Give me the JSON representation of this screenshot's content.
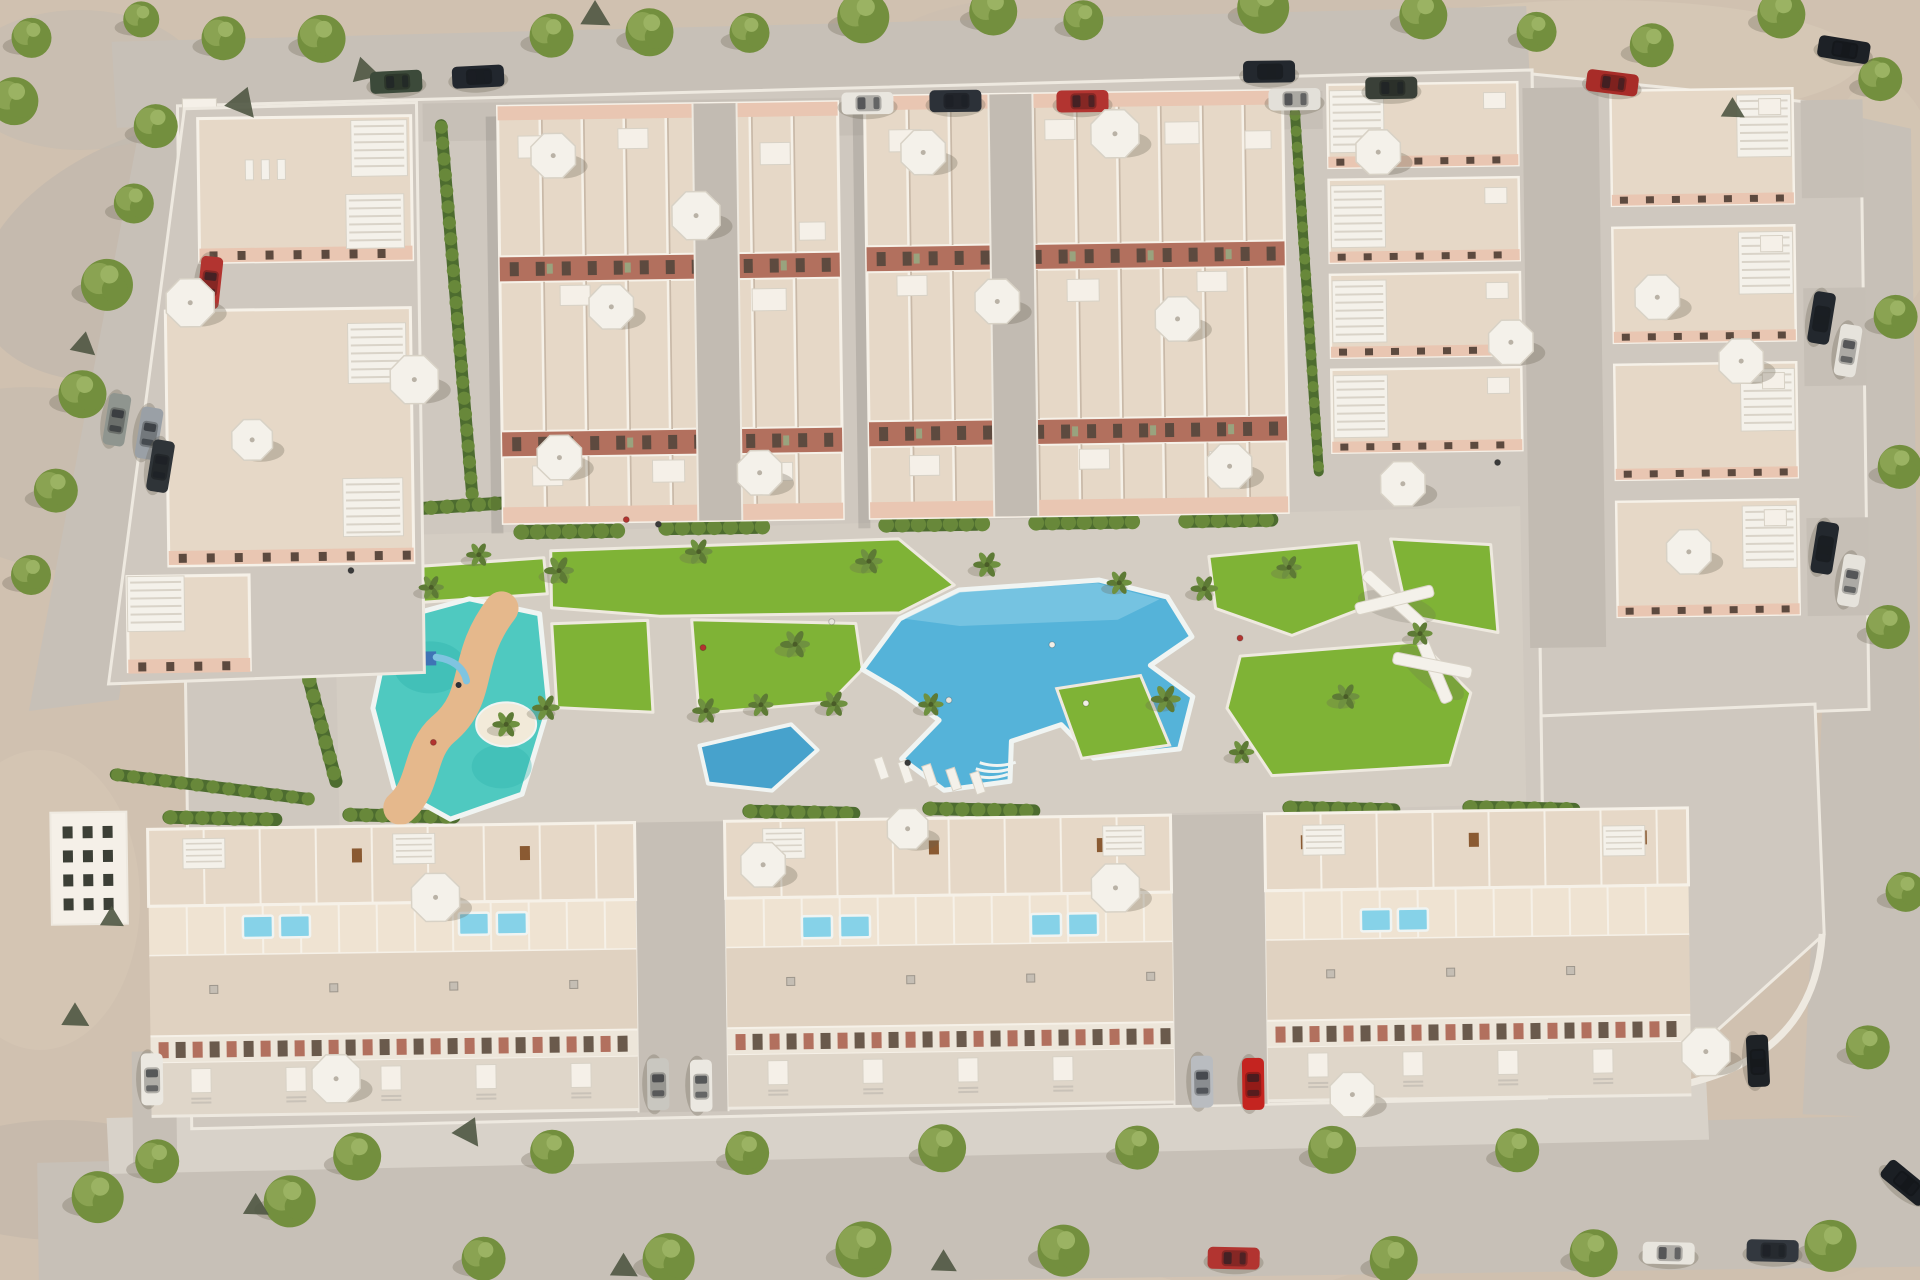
{
  "meta": {
    "title": "Aerial 3D render of a residential complex with pools and gardens"
  },
  "scene": {
    "width": 1920,
    "height": 1280,
    "tilt": -0.8
  },
  "palette": {
    "sand": "#d0c1b0",
    "road": "#c7c0b7",
    "sidewalk": "#d8d2c9",
    "paving": "#cfc8bf",
    "esplanade": "#d5cec4",
    "aisle": "#c6bfb6",
    "walkway": "#c2bbb2",
    "terrace": "#e6d8c7",
    "terraceLight": "#efe3d2",
    "roof": "#e0d2c1",
    "parapet": "#f6f1e8",
    "boxFill": "#f5f0e8",
    "wallShadow": "#c9b9a8",
    "facadePink": "#e9c6b2",
    "facadeTerracotta": "#b2705e",
    "windowDark": "#5d4a3f",
    "windowPair": "#6a5a4c",
    "shutterGreen": "#99a37e",
    "lawn": "#7fb336",
    "lawnEdge": "#eee9df",
    "hedge": "#4d6c2f",
    "bushA": "#68883a",
    "bushB": "#577a30",
    "pool": "#55b3d9",
    "poolLight": "#8fd0e8",
    "poolRim": "#f0f4f2",
    "lagoon": "#47a2cc",
    "kidsPool": "#4fc9c0",
    "kidsPoolDark": "#2fb3ac",
    "sandPath": "#e5b88c",
    "miniPool": "#86d2e8",
    "treeShadow": "#6b6453",
    "treeA": "#8aa352",
    "treeB": "#738f3e",
    "treeC": "#9bb363",
    "palmA": "#5d7a35",
    "palmB": "#6f9140",
    "white": "#f4f1ea",
    "umbrellaEdge": "#d8d2c6",
    "furniture": "#8a5a32",
    "rock": "#4f5742",
    "slatLine": "#d9d3c8",
    "curb": "#eee9e0"
  },
  "terrain_patches": [
    [
      170,
      250,
      200,
      120,
      -20,
      "#b9b3ac",
      0.5
    ],
    [
      60,
      480,
      160,
      90,
      10,
      "#bdb7b0",
      0.4
    ],
    [
      300,
      1215,
      240,
      70,
      0,
      "#c0b4a6",
      0.35
    ],
    [
      900,
      1235,
      500,
      90,
      0,
      "#dccdbb",
      0.5
    ],
    [
      1600,
      60,
      260,
      60,
      0,
      "#ddd0bd",
      0.4
    ],
    [
      1200,
      35,
      300,
      50,
      0,
      "#c8bcae",
      0.3
    ],
    [
      500,
      1255,
      300,
      60,
      0,
      "#c6b8a8",
      0.4
    ],
    [
      1500,
      1240,
      400,
      70,
      0,
      "#cdbfb0",
      0.4
    ],
    [
      80,
      80,
      120,
      70,
      0,
      "#c2bbb2",
      0.5
    ],
    [
      40,
      900,
      100,
      150,
      0,
      "#d9cab8",
      0.4
    ],
    [
      1880,
      200,
      60,
      120,
      0,
      "#d8cab8",
      0.4
    ],
    [
      700,
      60,
      200,
      40,
      0,
      "#cfc2b2",
      0.35
    ],
    [
      60,
      1180,
      140,
      60,
      0,
      "#b4aca2",
      0.3
    ],
    [
      1750,
      1180,
      160,
      60,
      0,
      "#c4b6a6",
      0.35
    ]
  ],
  "roads": {
    "top": "120,30 1535,14 1538,100 124,116",
    "left": "150,100 222,96 118,688 28,698",
    "bottom": "30,1150 1920,1128 1920,1280 30,1280",
    "bottom_sidewalk": "100,1106 1700,1092 1702,1150 102,1162",
    "right": "1858,128 1918,142 1918,1132 1796,1126"
  },
  "complex": {
    "plates": [
      "185,95 1540,78 1540,1106 185,1118",
      "1540,82 1868,120 1868,722 1540,730",
      "1540,724 1814,716 1820,946 1642,1102 1540,1104"
    ],
    "north_sidewalk": [
      430,
      96,
      900,
      38
    ],
    "esplanade": "335,528 1522,514 1524,812 337,826",
    "se_curve": "M 1642,1100 Q 1808,1082 1818,946",
    "gate_box": [
      190,
      88,
      34,
      20
    ],
    "sw_building": [
      48,
      800,
      76,
      112
    ],
    "row1_west_drive": [
      126,
      1040,
      44,
      112
    ]
  },
  "top_blocks": [
    {
      "x": 505,
      "y": 100,
      "w": 340,
      "h": 417,
      "walk": 700,
      "boxes": [
        [
          20,
          30,
          34,
          22
        ],
        [
          120,
          24,
          30,
          20
        ],
        [
          262,
          40,
          30,
          22
        ],
        [
          60,
          180,
          30,
          20
        ],
        [
          252,
          186,
          34,
          22
        ],
        [
          300,
          120,
          26,
          18
        ],
        [
          30,
          360,
          30,
          20
        ],
        [
          150,
          356,
          32,
          22
        ],
        [
          262,
          360,
          28,
          18
        ]
      ]
    },
    {
      "x": 872,
      "y": 95,
      "w": 418,
      "h": 422,
      "walk": 996,
      "boxes": [
        [
          24,
          34,
          32,
          22
        ],
        [
          180,
          26,
          30,
          20
        ],
        [
          300,
          30,
          34,
          22
        ],
        [
          380,
          40,
          26,
          18
        ],
        [
          30,
          180,
          30,
          20
        ],
        [
          200,
          186,
          32,
          22
        ],
        [
          330,
          180,
          30,
          20
        ],
        [
          40,
          360,
          30,
          20
        ],
        [
          210,
          356,
          30,
          20
        ],
        [
          340,
          360,
          32,
          22
        ]
      ]
    }
  ],
  "left_apartments": {
    "base": "192,98 424,95 424,665 108,672",
    "buildings": [
      {
        "x": 205,
        "y": 108,
        "w": 213,
        "h": 144,
        "facY": 238,
        "slats": [
          [
            358,
            112,
            56,
            56
          ],
          [
            352,
            186,
            58,
            54
          ]
        ]
      },
      {
        "x": 170,
        "y": 300,
        "w": 245,
        "h": 255,
        "facY": 540,
        "slats": [
          [
            352,
            315,
            58,
            60
          ],
          [
            345,
            470,
            60,
            58
          ]
        ]
      },
      {
        "x": 128,
        "y": 565,
        "w": 122,
        "h": 95,
        "facY": 648,
        "slats": [
          [
            128,
            565,
            57,
            55
          ]
        ]
      }
    ],
    "loungers": [
      [
        252,
        150
      ],
      [
        268,
        150
      ],
      [
        284,
        150
      ]
    ]
  },
  "right_columns": {
    "c1": {
      "x": 1335,
      "w": 190,
      "ys": [
        90,
        185,
        280,
        375
      ],
      "h": 83,
      "slatSide": "w"
    },
    "c2": {
      "x": 1618,
      "w": 182,
      "ys": [
        100,
        237,
        374,
        511
      ],
      "h": 115,
      "slatSide": "e"
    },
    "lane": [
      1530,
      96,
      76,
      560
    ],
    "driveways": [
      [
        1808,
        112,
        62,
        98
      ],
      [
        1808,
        300,
        62,
        98
      ],
      [
        1808,
        530,
        62,
        98
      ]
    ]
  },
  "amenity": {
    "lawns": [
      "552,545 900,538 955,585 900,612 660,612 552,602",
      "552,618 648,616 652,708 556,702",
      "692,616 856,622 862,668 830,700 698,710",
      "398,560 545,552 548,588 402,596",
      "1210,560 1360,548 1368,612 1292,640 1216,612",
      "1392,545 1492,552 1498,640 1408,622",
      "1240,660 1420,648 1470,700 1448,772 1270,780 1226,712"
    ],
    "pool": {
      "body": "900,618 960,590 1100,582 1168,600 1192,640 1150,668 1192,700 1178,752 1092,760 1060,726 1010,742 1008,782 942,790 900,758 938,720 898,690 862,668",
      "light": "905,618 960,592 1098,585 1160,602 1118,622 960,626",
      "island": "1056,690 1140,678 1168,748 1080,760",
      "steps": [
        988,
        775
      ]
    },
    "lagoon": "698,742 790,722 816,748 770,788 706,780",
    "kids_pool": {
      "body": "392,612 470,592 540,608 548,700 520,788 448,812 392,780 372,700",
      "path": "M 502,602 C 462,652 482,690 442,722 C 416,744 424,778 398,800",
      "island": [
        505,
        718,
        30,
        22
      ],
      "playground": [
        424,
        644
      ]
    },
    "pergolas": [
      [
        1395,
        606,
        15
      ],
      [
        1432,
        672,
        40
      ]
    ],
    "loungers": [
      [
        872,
        758
      ],
      [
        896,
        762
      ],
      [
        920,
        766
      ],
      [
        944,
        770
      ],
      [
        968,
        774
      ]
    ],
    "people": [
      [
        660,
        520,
        "#3a3a3a"
      ],
      [
        703,
        644,
        "#b23430"
      ],
      [
        832,
        620,
        "#e8e5de"
      ],
      [
        906,
        762,
        "#3a3a3a"
      ],
      [
        1240,
        642,
        "#b23430"
      ],
      [
        352,
        562,
        "#3a3a3a"
      ],
      [
        432,
        735,
        "#b23430"
      ],
      [
        948,
        700,
        "#e8e5de"
      ],
      [
        1052,
        646,
        "#f2efe8"
      ],
      [
        1085,
        705,
        "#f2efe8"
      ],
      [
        628,
        515,
        "#b23430"
      ],
      [
        1500,
        470,
        "#3a3a3a"
      ]
    ]
  },
  "bottom_rows": {
    "rows": [
      {
        "x": 145,
        "w": 487
      },
      {
        "x": 722,
        "w": 446
      },
      {
        "x": 1262,
        "w": 423
      }
    ],
    "bands": {
      "back": [
        818,
        895
      ],
      "pools": [
        895,
        945
      ],
      "roof": [
        945,
        1025
      ],
      "windows": [
        1025,
        1052
      ],
      "front": [
        1052,
        1105
      ]
    },
    "aisles": [
      [
        632,
        818,
        90,
        290
      ],
      [
        1168,
        818,
        94,
        290
      ]
    ],
    "slat_boxes": [
      [
        180,
        828
      ],
      [
        390,
        826
      ],
      [
        760,
        826
      ],
      [
        1100,
        828
      ],
      [
        1300,
        830
      ],
      [
        1600,
        835
      ]
    ],
    "mini_pools": [
      [
        254,
        917
      ],
      [
        291,
        917
      ],
      [
        470,
        917
      ],
      [
        508,
        917
      ],
      [
        813,
        925
      ],
      [
        851,
        925
      ],
      [
        1042,
        926
      ],
      [
        1079,
        926
      ],
      [
        1372,
        926
      ],
      [
        1409,
        926
      ]
    ]
  },
  "hedges": [
    [
      515,
      526,
      105,
      14,
      0
    ],
    [
      660,
      524,
      105,
      14,
      0
    ],
    [
      880,
      524,
      105,
      14,
      0
    ],
    [
      1030,
      524,
      105,
      14,
      0
    ],
    [
      1180,
      524,
      100,
      14,
      0
    ],
    [
      448,
      112,
      380,
      12,
      86
    ],
    [
      1584,
      108,
      530,
      12,
      90
    ],
    [
      1302,
      112,
      370,
      10,
      87
    ],
    [
      160,
      806,
      120,
      13,
      2
    ],
    [
      340,
      806,
      118,
      13,
      2
    ],
    [
      740,
      808,
      118,
      13,
      2
    ],
    [
      920,
      808,
      118,
      13,
      2
    ],
    [
      1280,
      812,
      118,
      13,
      2
    ],
    [
      1460,
      814,
      118,
      13,
      2
    ],
    [
      108,
      762,
      205,
      12,
      8
    ],
    [
      303,
      648,
      135,
      13,
      76
    ],
    [
      345,
      505,
      195,
      13,
      -3
    ]
  ],
  "trees": [
    [
      232,
      28,
      22
    ],
    [
      330,
      30,
      24
    ],
    [
      560,
      30,
      22
    ],
    [
      658,
      28,
      24
    ],
    [
      758,
      30,
      20
    ],
    [
      872,
      16,
      26
    ],
    [
      1002,
      12,
      24
    ],
    [
      1092,
      22,
      20
    ],
    [
      1272,
      12,
      26
    ],
    [
      1432,
      22,
      24
    ],
    [
      1545,
      40,
      20
    ],
    [
      1660,
      55,
      22
    ],
    [
      1790,
      26,
      24
    ],
    [
      1888,
      92,
      22
    ],
    [
      40,
      25,
      20
    ],
    [
      150,
      8,
      18
    ],
    [
      22,
      88,
      24
    ],
    [
      163,
      115,
      22
    ],
    [
      140,
      192,
      20
    ],
    [
      112,
      273,
      26
    ],
    [
      86,
      382,
      24
    ],
    [
      58,
      478,
      22
    ],
    [
      32,
      562,
      20
    ],
    [
      150,
      1150,
      22
    ],
    [
      350,
      1148,
      24
    ],
    [
      545,
      1146,
      22
    ],
    [
      740,
      1150,
      22
    ],
    [
      935,
      1148,
      24
    ],
    [
      1130,
      1150,
      22
    ],
    [
      1325,
      1155,
      24
    ],
    [
      1510,
      1158,
      22
    ],
    [
      90,
      1185,
      26
    ],
    [
      282,
      1192,
      26
    ],
    [
      660,
      1255,
      26
    ],
    [
      855,
      1248,
      28
    ],
    [
      1055,
      1252,
      26
    ],
    [
      475,
      1252,
      22
    ],
    [
      1385,
      1266,
      24
    ],
    [
      1585,
      1262,
      24
    ],
    [
      1822,
      1258,
      26
    ],
    [
      1900,
      330,
      22
    ],
    [
      1902,
      480,
      22
    ],
    [
      1888,
      640,
      22
    ],
    [
      1902,
      905,
      20
    ],
    [
      1862,
      1060,
      22
    ]
  ],
  "palms": [
    [
      560,
      565,
      13
    ],
    [
      700,
      548,
      12
    ],
    [
      795,
      642,
      13
    ],
    [
      833,
      702,
      12
    ],
    [
      988,
      565,
      12
    ],
    [
      545,
      702,
      12
    ],
    [
      432,
      580,
      11
    ],
    [
      705,
      707,
      12
    ],
    [
      870,
      560,
      12
    ],
    [
      930,
      704,
      11
    ],
    [
      760,
      702,
      11
    ],
    [
      480,
      548,
      11
    ],
    [
      1205,
      592,
      12
    ],
    [
      1165,
      702,
      13
    ],
    [
      1290,
      572,
      11
    ],
    [
      1345,
      702,
      12
    ],
    [
      505,
      718,
      12
    ],
    [
      1120,
      585,
      11
    ],
    [
      1240,
      756,
      11
    ],
    [
      1420,
      640,
      11
    ]
  ],
  "rocks": [
    [
      250,
      92,
      16,
      20
    ],
    [
      372,
      62,
      14,
      -15
    ],
    [
      604,
      10,
      15,
      0
    ],
    [
      88,
      332,
      13,
      10
    ],
    [
      70,
      1004,
      14,
      0
    ],
    [
      462,
      1124,
      15,
      25
    ],
    [
      248,
      1196,
      13,
      0
    ],
    [
      615,
      1262,
      14,
      0
    ],
    [
      935,
      1262,
      13,
      0
    ],
    [
      108,
      906,
      12,
      0
    ],
    [
      1740,
      120,
      12,
      0
    ]
  ],
  "cars": [
    [
      404,
      74,
      -2,
      "#3c4a3a"
    ],
    [
      486,
      70,
      -2,
      "#22272e"
    ],
    [
      875,
      102,
      0,
      "#e9e6df"
    ],
    [
      963,
      101,
      0,
      "#2c3138"
    ],
    [
      1090,
      103,
      0,
      "#b23430"
    ],
    [
      1277,
      76,
      0,
      "#23282e"
    ],
    [
      1302,
      104,
      0,
      "#e3e0d9"
    ],
    [
      1399,
      94,
      0,
      "#3a4038"
    ],
    [
      1620,
      92,
      8,
      "#a82c28"
    ],
    [
      215,
      272,
      97,
      "#b23430"
    ],
    [
      152,
      422,
      100,
      "#9aa0a6"
    ],
    [
      163,
      455,
      100,
      "#2f3438"
    ],
    [
      120,
      408,
      100,
      "#8f958f"
    ],
    [
      1826,
      330,
      100,
      "#23282e"
    ],
    [
      1852,
      363,
      100,
      "#e6e3dc"
    ],
    [
      1826,
      560,
      100,
      "#23282e"
    ],
    [
      1852,
      593,
      100,
      "#e6e3dc"
    ],
    [
      1852,
      62,
      10,
      "#1d2126"
    ],
    [
      652,
      1080,
      90,
      "#c9c7c0"
    ],
    [
      695,
      1082,
      90,
      "#ebe8e1"
    ],
    [
      1196,
      1085,
      90,
      "#b9bcc0"
    ],
    [
      1247,
      1088,
      90,
      "#c42420"
    ],
    [
      146,
      1068,
      90,
      "#ebe8e1"
    ],
    [
      1752,
      1072,
      88,
      "#1e2226"
    ],
    [
      1225,
      1262,
      2,
      "#b23430"
    ],
    [
      1660,
      1263,
      2,
      "#e8e5de"
    ],
    [
      1764,
      1262,
      2,
      "#33383f"
    ],
    [
      1898,
      1196,
      40,
      "#1b1f24"
    ]
  ],
  "umbrellas": [
    [
      560,
      150,
      24
    ],
    [
      702,
      212,
      26
    ],
    [
      616,
      302,
      24
    ],
    [
      562,
      452,
      24
    ],
    [
      762,
      470,
      24
    ],
    [
      930,
      152,
      24
    ],
    [
      1122,
      136,
      26
    ],
    [
      1002,
      302,
      24
    ],
    [
      1182,
      322,
      24
    ],
    [
      1232,
      470,
      24
    ],
    [
      195,
      292,
      26
    ],
    [
      418,
      372,
      26
    ],
    [
      255,
      430,
      22
    ],
    [
      1385,
      158,
      24
    ],
    [
      1515,
      350,
      24
    ],
    [
      1662,
      307,
      24
    ],
    [
      1745,
      372,
      24
    ],
    [
      1405,
      490,
      24
    ],
    [
      1690,
      562,
      24
    ],
    [
      432,
      890,
      26
    ],
    [
      760,
      862,
      24
    ],
    [
      1112,
      890,
      26
    ],
    [
      330,
      1070,
      26
    ],
    [
      1346,
      1100,
      24
    ],
    [
      1700,
      1062,
      26
    ],
    [
      905,
      828,
      22
    ]
  ]
}
